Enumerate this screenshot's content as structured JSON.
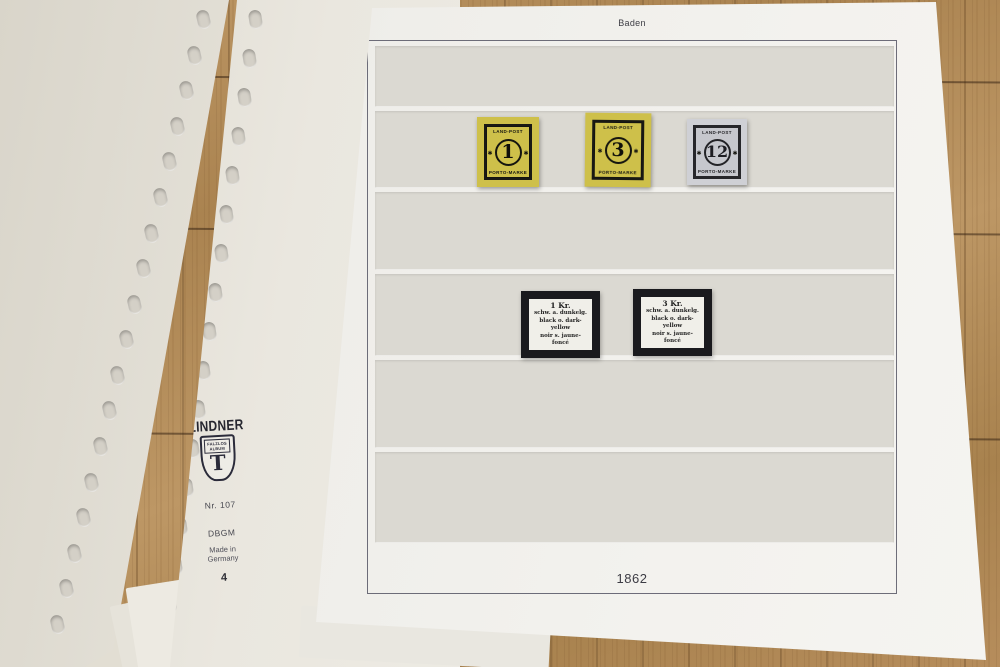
{
  "album_page": {
    "region_label": "Baden",
    "year_label": "1862",
    "stamps": [
      {
        "value": "1",
        "top_text": "LAND-POST",
        "bottom_text": "PORTO-MARKE",
        "paper_color": "#cec04a",
        "ink_color": "#191914"
      },
      {
        "value": "3",
        "top_text": "LAND-POST",
        "bottom_text": "PORTO-MARKE",
        "paper_color": "#cabb3e",
        "ink_color": "#191914"
      },
      {
        "value": "12",
        "top_text": "LAND-POST",
        "bottom_text": "PORTO-MARKE",
        "paper_color": "#c6c7cd",
        "ink_color": "#26262a"
      }
    ],
    "mount_labels": [
      {
        "lines": [
          "1 Kr.",
          "schw. a. dunkelg.",
          "black o. dark-",
          "yellow",
          "noir s. jaune-",
          "foncé"
        ]
      },
      {
        "lines": [
          "3 Kr.",
          "schw. a. dunkelg.",
          "black o. dark-",
          "yellow",
          "noir s. jaune-",
          "foncé"
        ]
      }
    ]
  },
  "binder_page": {
    "brand": "LINDNER",
    "shield_line1": "FALZLOS",
    "shield_line2": "ALBUM",
    "shield_letter": "T",
    "item_number": "Nr. 107",
    "dbgm": "DBGM",
    "made_in_line1": "Made in",
    "made_in_line2": "Germany",
    "page_number": "4"
  },
  "colors": {
    "wood": "#b18a56",
    "album_page": "#f0efeb",
    "pocket_strip": "#dbd9d2",
    "sheet_cream": "#eae7df",
    "logo_navy": "#2b2b3a"
  }
}
